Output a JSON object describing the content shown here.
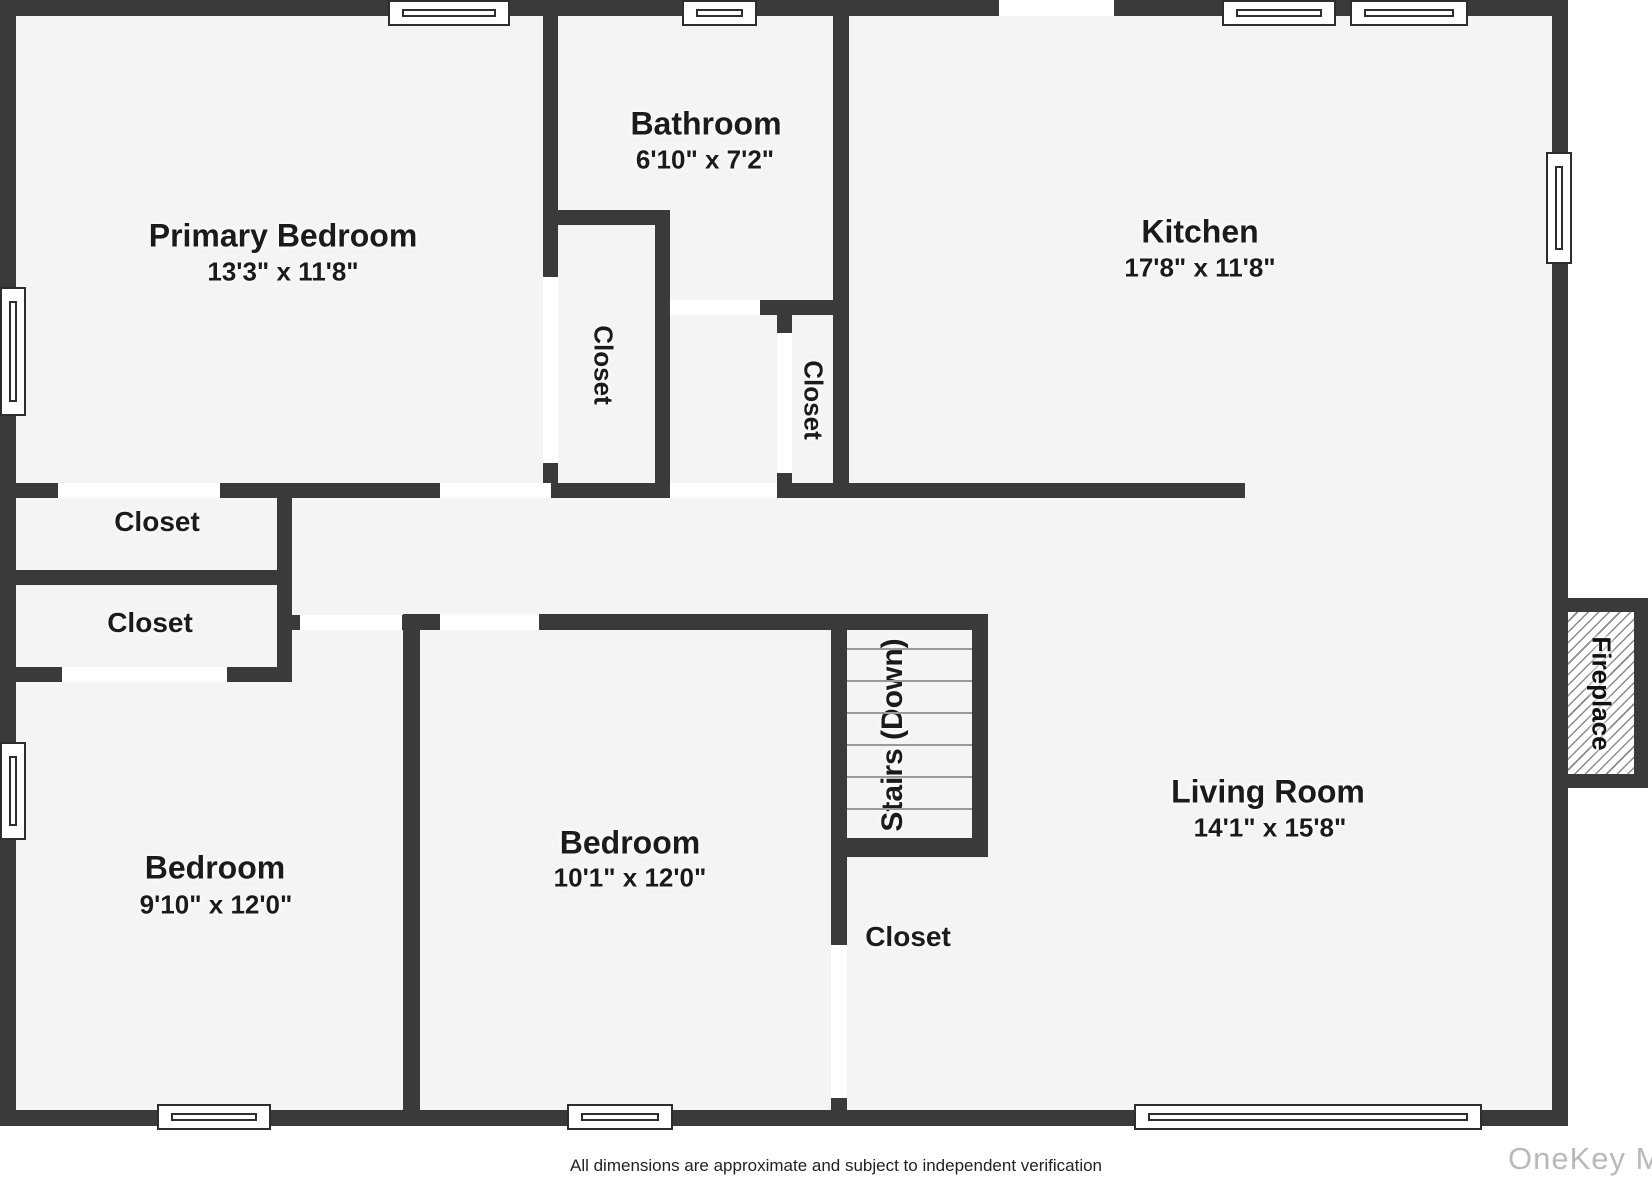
{
  "rooms": {
    "primary_bedroom": {
      "name": "Primary Bedroom",
      "dims": "13'3\" x 11'8\""
    },
    "bathroom": {
      "name": "Bathroom",
      "dims": "6'10\" x 7'2\""
    },
    "kitchen": {
      "name": "Kitchen",
      "dims": "17'8\" x 11'8\""
    },
    "bedroom_left": {
      "name": "Bedroom",
      "dims": "9'10\" x 12'0\""
    },
    "bedroom_middle": {
      "name": "Bedroom",
      "dims": "10'1\" x 12'0\""
    },
    "living_room": {
      "name": "Living Room",
      "dims": "14'1\" x 15'8\""
    },
    "stairs": {
      "name": "Stairs (Down)"
    },
    "fireplace": {
      "name": "Fireplace"
    }
  },
  "closets": {
    "bathroom_closet": "Closet",
    "hall_closet": "Closet",
    "left_closet_upper": "Closet",
    "left_closet_lower": "Closet",
    "under_stairs_closet": "Closet"
  },
  "footer": {
    "disclaimer": "All dimensions are approximate and subject to independent verification"
  },
  "watermark": {
    "text": "OneKey MLS"
  },
  "colors": {
    "wall": "#3a3a3a",
    "floor": "#f4f4f4",
    "window_border": "#2e2e2e",
    "hatch": "#8a8a8a",
    "watermark": "#b9b9b9"
  }
}
